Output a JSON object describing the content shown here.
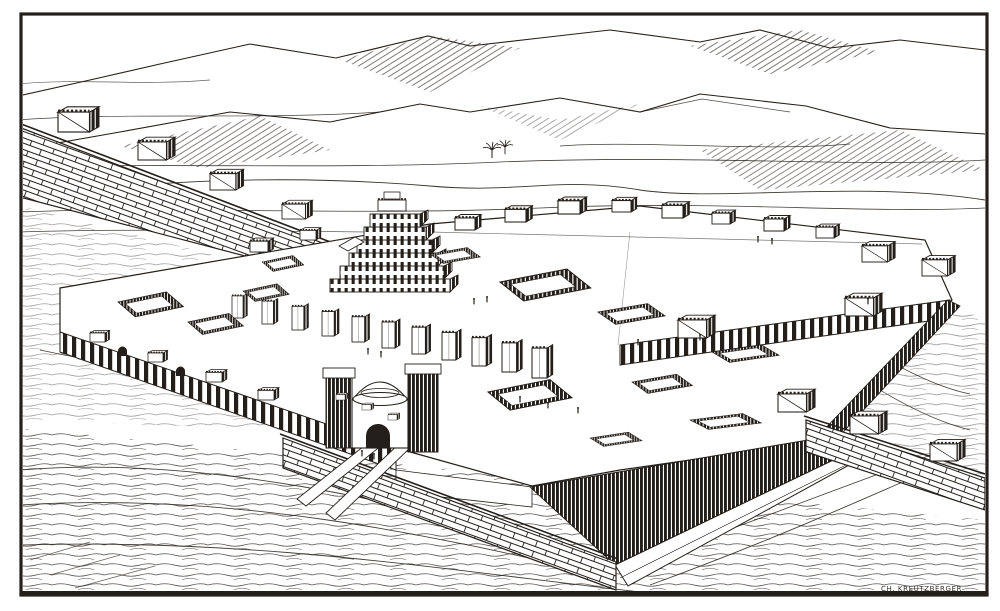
{
  "artwork": {
    "signature": "CH. KREUTZBERGER",
    "description": "Bird's-eye engraving of an ancient Mesopotamian palace citadel: stepped ziggurat, walled courtyards, domed arched gate with access ramps, crenellated city walls with towers, mountain ranges on the horizon, two small palm trees on the plain."
  },
  "palette": {
    "ink": "#241f1a",
    "paper": "#ffffff"
  },
  "scene": {
    "elements": [
      "frame",
      "mountains",
      "plain",
      "palm-trees",
      "city-wall-left",
      "city-wall-right",
      "citadel-platform",
      "upper-terrace",
      "colonnade-wall",
      "esplanade-wall",
      "terrace-dark-wall",
      "brick-retaining-wall",
      "glacis",
      "access-ramps",
      "domed-gate",
      "ziggurat",
      "pylon-row",
      "courtyards",
      "roof-structures",
      "figures",
      "ground-texture",
      "engraver-signature"
    ]
  }
}
